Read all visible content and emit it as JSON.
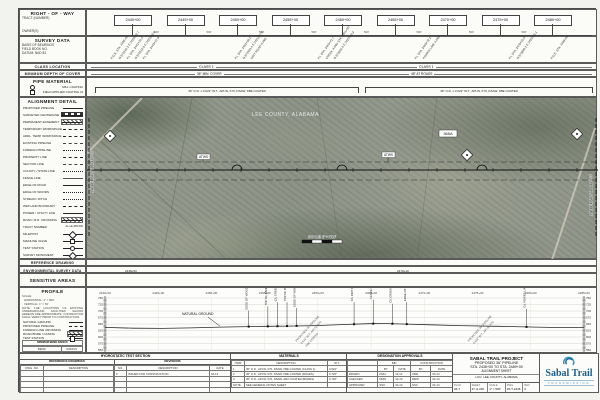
{
  "sheet": {
    "brand_blue": "#1e5f8e",
    "sidebar": {
      "row": {
        "title": "RIGHT - OF - WAY",
        "rows": [
          "TRACT (NUMBER)",
          "OWNER(S)"
        ]
      },
      "survey": {
        "title": "SURVEY DATA",
        "rows": [
          "BASIS OF BEARINGS",
          "FIELD BOOK NO.",
          "DATUM: NAD 83"
        ]
      },
      "class_location": {
        "title": "CLASS LOCATION"
      },
      "depth": {
        "title": "MINIMUM DEPTH OF COVER"
      },
      "pipe_material": {
        "title": "PIPE MATERIAL",
        "rows": [
          "MILL COATING",
          "FIELD APPLIED COATING (SEE NOTES)"
        ]
      },
      "alignment_detail": {
        "title": "ALIGNMENT DETAIL",
        "items": [
          {
            "label": "PROPOSED PIPELINE",
            "style": "thick"
          },
          {
            "label": "SURVEYED CENTERLINE",
            "style": "check"
          },
          {
            "label": "PERMANENT EASEMENT",
            "style": "hatch"
          },
          {
            "label": "TEMPORARY WORKSPACE",
            "style": "dash"
          },
          {
            "label": "ADDL. TEMP. WORKSPACE",
            "style": "shortdash"
          },
          {
            "label": "EXISTING PIPELINE",
            "style": "dashdot"
          },
          {
            "label": "FOREIGN PIPELINE",
            "style": "dashdotdot"
          },
          {
            "label": "PROPERTY LINE",
            "style": "dash"
          },
          {
            "label": "SECTION LINE",
            "style": "dashdot"
          },
          {
            "label": "COUNTY / STATE LINE",
            "style": "dashdotdot"
          },
          {
            "label": "FENCE LINE",
            "style": "xline"
          },
          {
            "label": "EDGE OF ROAD",
            "style": "solid"
          },
          {
            "label": "EDGE OF WOODS",
            "style": "dot"
          },
          {
            "label": "STREAM / DITCH",
            "style": "dot"
          },
          {
            "label": "WETLAND BOUNDARY",
            "style": "shortdash"
          },
          {
            "label": "POWER / UTILITY LINE",
            "style": "tick"
          },
          {
            "label": "ROAD / R.R. CROSSING",
            "style": "hatch"
          },
          {
            "label": "TRACT NUMBER",
            "style": "text",
            "sample": "AL-LE-365.000"
          },
          {
            "label": "MILEPOST",
            "style": "diamond"
          },
          {
            "label": "MAINLINE VALVE",
            "style": "square"
          },
          {
            "label": "TEST STATION",
            "style": "circle"
          },
          {
            "label": "SURVEY MONUMENT",
            "style": "diamond"
          }
        ]
      },
      "reference_drawing": {
        "title": "REFERENCE DRAWING"
      },
      "environmental": {
        "title": "ENVIRONMENTAL SURVEY DATA"
      },
      "sensitive": {
        "title": "SENSITIVE AREAS"
      },
      "profile_box": {
        "title": "PROFILE",
        "scale_lines": [
          "SCALE:",
          "HORIZONTAL: 1\" = 500'",
          "VERTICAL: 1\" = 50'"
        ],
        "note": "NOTE: THE LOCATIONS OF EXISTING UNDERGROUND FACILITIES SHOWN HEREON ARE APPROXIMATE. CONTRACTOR SHALL VERIFY PRIOR TO CONSTRUCTION.",
        "legend": [
          {
            "label": "NATURAL GROUND",
            "style": "solid"
          },
          {
            "label": "PROPOSED PIPELINE",
            "style": "dash"
          },
          {
            "label": "FOREIGN LINE CROSSING",
            "style": "tick"
          },
          {
            "label": "ROAD BORE / CASING",
            "style": "hatch"
          },
          {
            "label": "TEST STATION",
            "style": "square"
          }
        ],
        "table": {
          "header": "MINIMUM BEND RADIUS",
          "cols": [
            "BEND",
            "RADIUS"
          ],
          "rows": [
            [
              "36\" FIELD BEND",
              "40'"
            ],
            [
              "36\" ELASTIC",
              "1430'"
            ]
          ]
        }
      }
    },
    "header": {
      "stations": [
        "2440+00",
        "2445+00",
        "2450+00",
        "2455+00",
        "2460+00",
        "2465+00",
        "2470+00",
        "2475+00",
        "2480+00"
      ],
      "interval_label": "500'",
      "survey_callouts": [
        {
          "x": 26,
          "text": "P.O.B. STA. 2436+00"
        },
        {
          "x": 34,
          "text": "N 872341.2  E 2419856.7"
        },
        {
          "x": 42,
          "text": "P.I. STA. 2441+26.4"
        },
        {
          "x": 50,
          "text": "N 872512.8  E 2420318.5"
        },
        {
          "x": 58,
          "text": "P.I. STA. 2443+07.9"
        },
        {
          "x": 150,
          "text": "P.I. STA. 2452+88.1"
        },
        {
          "x": 158,
          "text": "N 872955.4  E 2421267.0"
        },
        {
          "x": 166,
          "text": "DIRT ROAD X-ING"
        },
        {
          "x": 233,
          "text": "P.I. STA. 2460+41.7"
        },
        {
          "x": 241,
          "text": "CREEK X-ING STA. 2461+80"
        },
        {
          "x": 249,
          "text": "N 873301.6  E 2422019.3"
        },
        {
          "x": 330,
          "text": "P.I. STA. 2468+02.2"
        },
        {
          "x": 338,
          "text": "POWER LINE X-ING"
        },
        {
          "x": 424,
          "text": "P.I. STA. 2478+55.0"
        },
        {
          "x": 432,
          "text": "N 873890.2  E 2423455.1"
        },
        {
          "x": 466,
          "text": "P.O.E. STA. 2489+00"
        }
      ],
      "class_values": [
        {
          "x": 110,
          "text": "CLASS 1"
        },
        {
          "x": 330,
          "text": "CLASS 1"
        }
      ],
      "depth_values": [
        {
          "x": 108,
          "text": "36\" MIN. COVER"
        },
        {
          "x": 322,
          "text": "48\" AT ROADS"
        }
      ],
      "pipe_spans": [
        {
          "x": 8,
          "w": 262,
          "label": "36\" O.D. x 0.622\" W.T., API-5L X70, DSAW, FBE COATED"
        },
        {
          "x": 278,
          "w": 226,
          "label": "36\" O.D. x 0.622\" W.T., API-5L X70, DSAW, FBE COATED"
        }
      ]
    },
    "map": {
      "county_label": "LEE COUNTY, ALABAMA",
      "tract_label": "365A",
      "tag_labels": [
        "ATWS",
        "ATWS"
      ],
      "scale_label": "SCALE: 1\" = 500'",
      "matchline_left": "MATCHLINE STA. 2436+00",
      "matchline_right": "MATCHLINE STA. 2489+00"
    },
    "midrows": {
      "env_labels": [
        {
          "x": 38,
          "text": "2438+50"
        },
        {
          "x": 310,
          "text": "2470+10"
        }
      ]
    },
    "profile": {
      "stations": [
        "2440+00",
        "2445+00",
        "2450+00",
        "2455+00",
        "2460+00",
        "2465+00",
        "2470+00",
        "2475+00",
        "2480+00",
        "2485+00"
      ],
      "elevations": [
        750,
        725,
        700,
        675,
        650,
        625,
        600,
        575,
        550
      ],
      "natural_ground": "NATURAL GROUND",
      "ground": [
        [
          0,
          637
        ],
        [
          6,
          634
        ],
        [
          12,
          633
        ],
        [
          18,
          635
        ],
        [
          24,
          638
        ],
        [
          30,
          640
        ],
        [
          34,
          641
        ],
        [
          38,
          642
        ],
        [
          44,
          644
        ],
        [
          50,
          648
        ],
        [
          55,
          651
        ],
        [
          58,
          652
        ],
        [
          62,
          650
        ],
        [
          68,
          647
        ],
        [
          74,
          644
        ],
        [
          82,
          641
        ],
        [
          90,
          638
        ],
        [
          96,
          636
        ],
        [
          100,
          636
        ]
      ],
      "crossings": [
        {
          "x": 30,
          "h": 16,
          "label": "EDGE OF WOODS"
        },
        {
          "x": 34,
          "h": 20,
          "label": "TOP OF BANK"
        },
        {
          "x": 36,
          "h": 24,
          "label": "C/L CREEK"
        },
        {
          "x": 38,
          "h": 24,
          "label": "TOP OF BANK"
        },
        {
          "x": 40,
          "h": 18,
          "label": "EDGE OF WOODS"
        },
        {
          "x": 52,
          "h": 22,
          "label": "C/L DIRT ROAD"
        },
        {
          "x": 56,
          "h": 24,
          "label": "FENCE LINE"
        },
        {
          "x": 60,
          "h": 20,
          "label": "C/L CREEK"
        },
        {
          "x": 63,
          "h": 22,
          "label": "EDGE OF WOODS"
        },
        {
          "x": 88,
          "h": 18,
          "label": "C/L POWER LINE"
        }
      ],
      "slant_groups": [
        {
          "x": 40,
          "lines": [
            "PROPOSED 36\" PIPELINE",
            "0.622\" W.T., API-5L X70",
            "FBE COATED"
          ]
        },
        {
          "x": 76,
          "lines": [
            "PROPOSED 36\" PIPELINE",
            "0.622\" W.T., API-5L X70"
          ]
        }
      ]
    },
    "bottom": {
      "hydro_title": "HYDROSTATIC TEST SECTION",
      "refdwgs": {
        "title": "REFERENCE DRAWINGS",
        "cols": [
          "DWG. NO.",
          "DESCRIPTION"
        ],
        "rows": [
          [
            "",
            ""
          ],
          [
            "",
            ""
          ],
          [
            "",
            ""
          ],
          [
            "",
            ""
          ],
          [
            "",
            ""
          ]
        ]
      },
      "revisions": {
        "title": "REVISIONS",
        "cols": [
          "NO.",
          "DESCRIPTION",
          "DATE"
        ],
        "rows": [
          [
            "0",
            "ISSUED FOR CONSTRUCTION",
            "04-14"
          ],
          [
            "",
            "",
            ""
          ],
          [
            "",
            "",
            ""
          ],
          [
            "",
            "",
            ""
          ],
          [
            "",
            "",
            ""
          ]
        ]
      },
      "materials": {
        "title": "MATERIALS",
        "cols": [
          "ITEM",
          "DESCRIPTION",
          "W.T."
        ],
        "rows": [
          [
            "1",
            "36\" O.D., API-5L X70, DSAW, FBE COATED (CLASS 1)",
            "0.622\""
          ],
          [
            "2",
            "36\" O.D., API-5L X70, DSAW, FBE COATED (ROADS)",
            "0.720\""
          ],
          [
            "3",
            "36\" O.D., API-5L X70, DSAW, ARO COATED (BORES)",
            "0.720\""
          ],
          [
            "NOTE",
            "SEE GENERAL NOTES SHEET",
            ""
          ]
        ]
      },
      "approvals": {
        "title": "DESIGNATION APPROVALS",
        "groups": [
          "BID",
          "CONSTRUCTION"
        ],
        "subcols": [
          "BY",
          "DATE",
          "BY",
          "DATE"
        ],
        "rows": [
          [
            "DRAWN",
            "KMH",
            "10-13",
            "KMH",
            "04-14"
          ],
          [
            "CHECKED",
            "DRW",
            "10-13",
            "DRW",
            "04-14"
          ],
          [
            "APPROVED",
            "SSC",
            "10-13",
            "SSC",
            "04-14"
          ]
        ]
      },
      "titleblock": {
        "line1": "SABAL TRAIL PROJECT",
        "line2": "PROPOSED 36\" PIPELINE",
        "line3": "STA. 2436+00 TO STA. 2489+00",
        "line4": "ALIGNMENT SHEET",
        "loc_label": "LOC:",
        "location": "LEE COUNTY, ALABAMA",
        "cells": [
          [
            "PLAN",
            "26-7"
          ],
          [
            "SHEET",
            "27 of 240"
          ],
          [
            "SCALE",
            "1\" = 500'"
          ],
          [
            "DWG",
            "26-T-2436"
          ],
          [
            "REV",
            "0"
          ]
        ]
      },
      "logo": {
        "name": "Sabal Trail",
        "sub": "TRANSMISSION"
      }
    }
  }
}
